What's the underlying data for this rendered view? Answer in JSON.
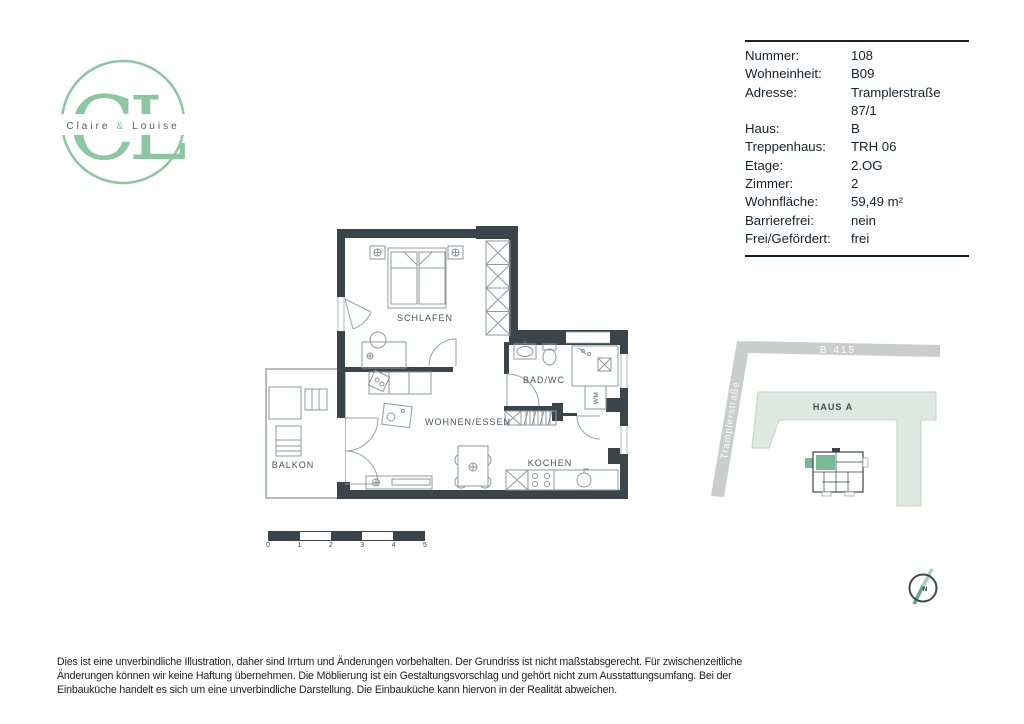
{
  "brand": {
    "monogram": "CL",
    "name_first": "Claire",
    "name_amp": "&",
    "name_second": "Louise"
  },
  "info": {
    "rows": [
      {
        "label": "Nummer:",
        "value": "108"
      },
      {
        "label": "Wohneinheit:",
        "value": "B09"
      },
      {
        "label": "Adresse:",
        "value": "Tramplerstraße 87/1"
      },
      {
        "label": "Haus:",
        "value": "B"
      },
      {
        "label": "Treppenhaus:",
        "value": "TRH 06"
      },
      {
        "label": "Etage:",
        "value": "2.OG"
      },
      {
        "label": "Zimmer:",
        "value": "2"
      },
      {
        "label": "Wohnfläche:",
        "value": "59,49 m²"
      },
      {
        "label": "Barrierefrei:",
        "value": "nein"
      },
      {
        "label": "Frei/Gefördert:",
        "value": "frei"
      }
    ]
  },
  "floorplan": {
    "labels": {
      "schlafen": "SCHLAFEN",
      "bad_wc": "BAD/WC",
      "wohnen_essen": "WOHNEN/ESSEN",
      "kochen": "KOCHEN",
      "balkon": "BALKON",
      "wm": "WM"
    }
  },
  "scalebar": {
    "ticks": [
      "0",
      "1",
      "2",
      "3",
      "4",
      "5"
    ]
  },
  "siteplan": {
    "road_top": "B 415",
    "road_left": "Tramplerstraße",
    "building": "HAUS A"
  },
  "compass": {
    "north": "N"
  },
  "disclaimer": {
    "lines": [
      "Dies ist eine unverbindliche Illustration, daher sind Irrtum und Änderungen vorbehalten. Der Grundriss ist nicht maßstabsgerecht. Für zwischenzeitliche",
      "Änderungen können wir keine Haftung übernehmen. Die Möblierung ist ein Gestaltungsvorschlag und gehört nicht zum Ausstattungsumfang. Bei der",
      "Einbauküche handelt es sich um eine unverbindliche Darstellung. Die Einbauküche kann hiervon in der Realität abweichen."
    ]
  },
  "colors": {
    "wall": "#3a454b",
    "brand_green": "#8cc7a2",
    "unit_green": "#79ba95",
    "haus_a_fill": "#dfe9e3",
    "road_gray": "#c9cdcb",
    "ink": "#15222c"
  }
}
